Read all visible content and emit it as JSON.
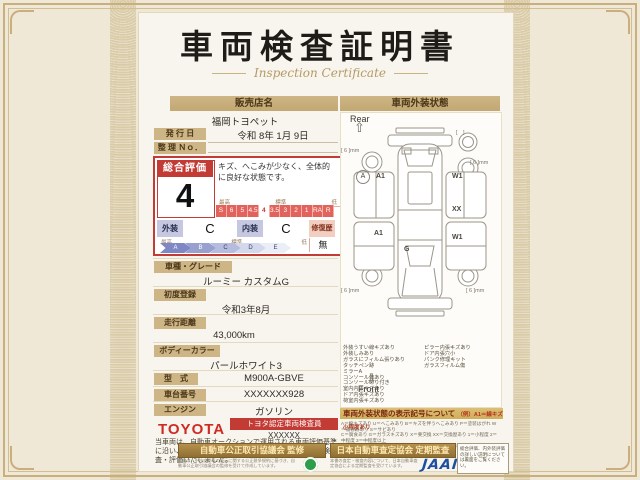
{
  "page": {
    "title": "車両検査証明書",
    "subtitle": "Inspection Certificate"
  },
  "dealer": {
    "header": "販売店名",
    "name": "福岡トヨペット",
    "issue_label": "発 行 日",
    "issue_value": "令和 8年 1月 9日",
    "ref_label": "整 理 Ｎｏ．"
  },
  "evaluation": {
    "label": "総合評価",
    "grade": "4",
    "comment": "キズ、へこみが少なく、全体的に良好な状態です。",
    "axis_high": "最高",
    "axis_mid": "標準",
    "axis_low": "低",
    "scale": [
      "S",
      "6",
      "5",
      "4.5",
      "4",
      "3.5",
      "3",
      "2",
      "1",
      "RA",
      "R"
    ],
    "exterior_label": "外装",
    "exterior_grade": "C",
    "interior_label": "内装",
    "interior_grade": "C",
    "repair_label": "修復歴",
    "repair_value": "無",
    "letters": [
      "A",
      "B",
      "C",
      "D",
      "E"
    ]
  },
  "details": {
    "rows": [
      {
        "label": "車種・グレード",
        "value": "ルーミー カスタムG"
      },
      {
        "label": "初度登録",
        "value": "令和3年8月"
      },
      {
        "label": "走行距離",
        "value": "43,000km"
      },
      {
        "label": "ボディーカラー",
        "value": "パールホワイト3"
      },
      {
        "label": "型　式",
        "value": "M900A-GBVE"
      },
      {
        "label": "車台番号",
        "value": "XXXXXXX928"
      },
      {
        "label": "エンジン",
        "value": "ガソリン"
      }
    ]
  },
  "certifier": {
    "brand": "TOYOTA",
    "badge": "トヨタ認定車両検査員",
    "inspector": "XXXXXX",
    "note": "当車両は、自動車オークションで運用される車両評価基準に沿い、トヨタユーゼックが認定した検査員が厳正に検査・評価いたしました。"
  },
  "exterior": {
    "header": "車両外装状態",
    "rear": "Rear",
    "front": "Front",
    "spare_label": "[　]",
    "tread": "[ 6 ]mm",
    "markers": {
      "a": "A",
      "a1_upper": "A1",
      "a1_lower": "A1",
      "w1_upper": "W1",
      "w1_lower": "W1",
      "xx": "XX",
      "g": "G"
    }
  },
  "conditions": {
    "left": [
      "外装うすい線キズあり",
      "外装しみあり",
      "ガラスにフィルム張りあり",
      "タッチペン跡",
      "ミラーA",
      "コンソール傷あり",
      "コンソールのり付き",
      "室内内張キズあり",
      "ドア内張キズあり",
      "荷室内張キズあり"
    ],
    "right": [
      "ピラー内張キズあり",
      "ドア内張穴小",
      "パンク修理キット",
      "ガラスフィルム傷"
    ]
  },
  "legend": {
    "title": "車両外装状態の表示記号について",
    "example": "（例）A1＝線キズ小程度あり",
    "lines": [
      "A＝線キズあり U＝へこみあり B＝キズを伴うへこみあり P＝塗装はがれ W＝補修跡あり S＝サビあり",
      "C＝腐食あり G＝ガラスキズあり X＝要交換 XX＝交換歴あり 1＝小程度 2＝中程度 3＝中程度以上",
      "・タイヤ残り溝表示は、残り溝をｍｍ単位で表示しています。"
    ]
  },
  "footer": {
    "fair_trade": {
      "title": "自動車公正取引協議会 監修",
      "note": "本書は、中古自動車の表示に関する公正競争規約に基づき、自動車公正取引協議会の監修を受けて作成しています。"
    },
    "jaai": {
      "title": "日本自動車査定協会 定期監査",
      "note": "本書の査定・検査内容について、日本自動車査定協会による定期監査を受けています。",
      "logo": "JAAI"
    },
    "back_note": "総合評価、内外装評価の詳しい説明については裏面をご覧ください。"
  }
}
